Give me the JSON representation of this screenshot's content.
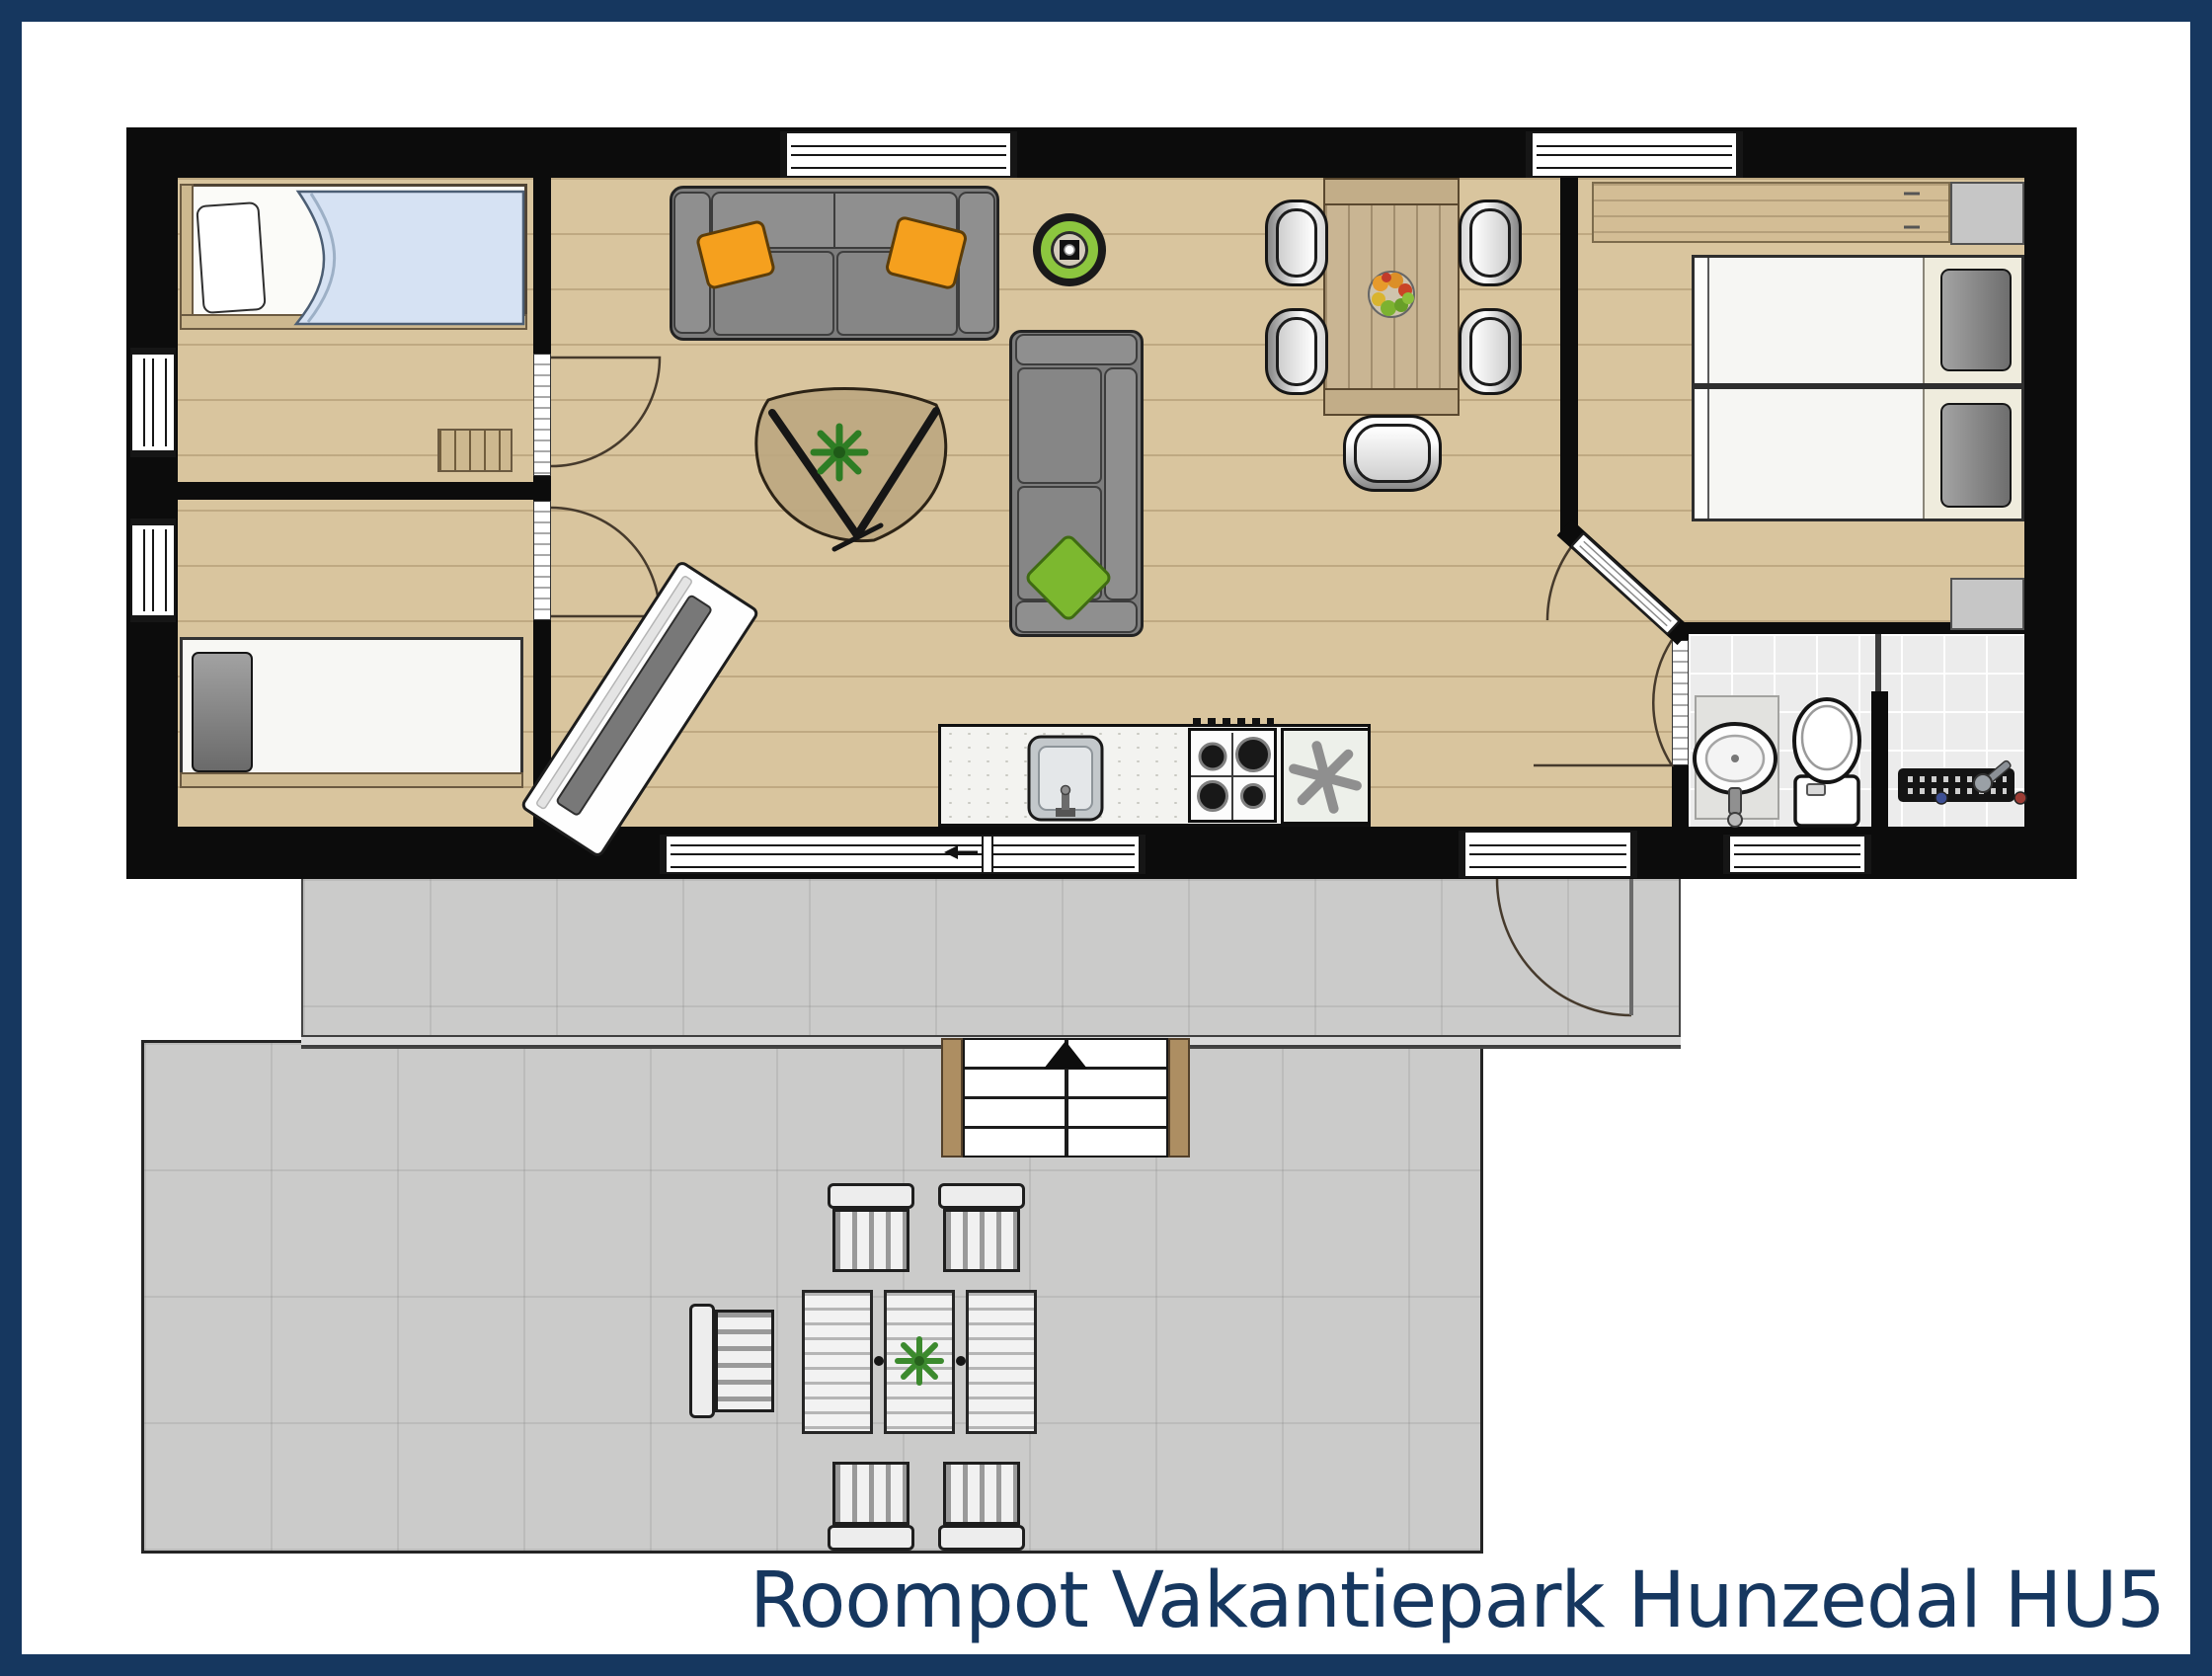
{
  "title": {
    "text": "Roompot Vakantiepark Hunzedal HU5",
    "color": "#16375f"
  },
  "frame": {
    "color": "#16375f"
  },
  "palette": {
    "wall_black": "#0c0c0c",
    "floor_wood": "#d9c59e",
    "terrace_gray": "#cbcbca",
    "bathroom_tile": "#ececec",
    "accent_orange": "#f5a01e",
    "accent_green": "#7cb82f",
    "table_wood": "#c9b593",
    "navy": "#16375f"
  },
  "floorplan": {
    "type": "vacation-home top-view floor plan",
    "rooms": [
      {
        "name": "bedroom-top-left",
        "furniture": [
          "single-bed-with-blue-blanket",
          "step-bench"
        ]
      },
      {
        "name": "bedroom-bottom-left",
        "furniture": [
          "single-bed-dark-pillow"
        ]
      },
      {
        "name": "living-room",
        "furniture": [
          "gray-sofa-orange-pillows",
          "chaise-sofa-green-pillow",
          "organic-coffee-table",
          "plant",
          "tv-board",
          "robot-vacuum"
        ]
      },
      {
        "name": "kitchen",
        "furniture": [
          "counter",
          "sink",
          "gas-hob-4-burners",
          "freezer-asterisk"
        ]
      },
      {
        "name": "dining-area",
        "furniture": [
          "plank-table",
          "fruit-bowl",
          "chair",
          "chair",
          "chair",
          "chair",
          "high-chair"
        ]
      },
      {
        "name": "bedroom-right",
        "furniture": [
          "twin-bed",
          "twin-bed",
          "desk-shelf",
          "wardrobe-top",
          "wardrobe-bottom"
        ]
      },
      {
        "name": "bathroom",
        "furniture": [
          "oval-wash-basin",
          "toilet",
          "shower-with-drain"
        ]
      }
    ],
    "doors": [
      "bedroom1-door-arc",
      "bedroom2-door-arc",
      "bedroom-right-diagonal-door",
      "bathroom-door-arc",
      "front-door-arc"
    ],
    "outdoor": {
      "upper-terrace": true,
      "lower-terrace": true,
      "stairs-with-up-arrow": true,
      "furniture": [
        "garden-chair",
        "garden-chair",
        "garden-chair",
        "garden-chair",
        "garden-side-chair",
        "slatted-garden-table",
        "plant"
      ]
    }
  }
}
